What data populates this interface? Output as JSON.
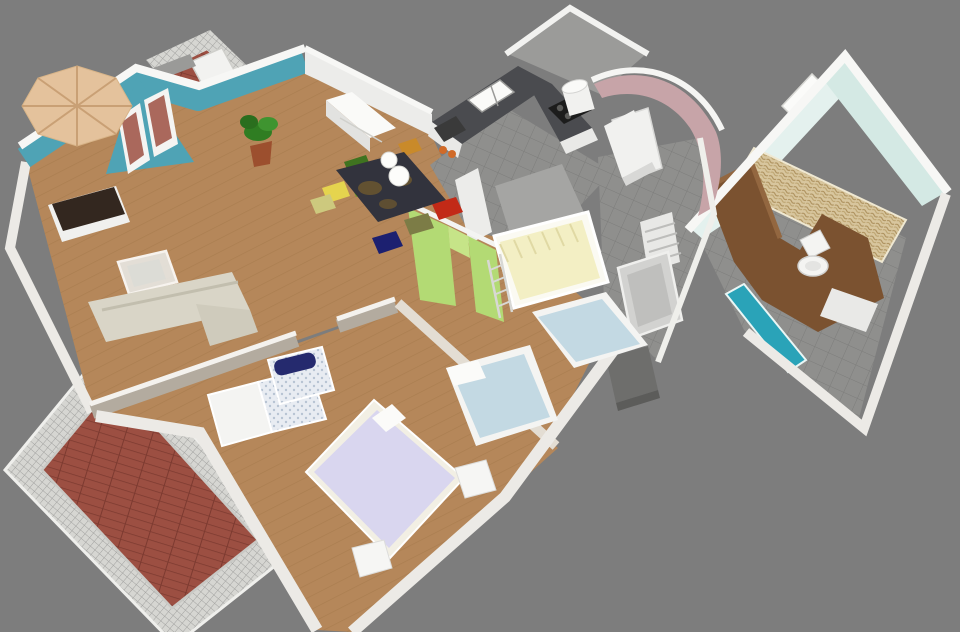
{
  "meta": {
    "width": 960,
    "height": 632,
    "description": "3D isometric cutaway rendering of a furnished apartment floor plan viewed from above on a plain gray background"
  },
  "palette": {
    "background": "#7d7d7d",
    "wall_white": "#ececea",
    "wall_cap": "#f7f7f5",
    "wall_outer": "#eceae6",
    "wall_greige": "#b3ab9f",
    "teal_wall": "#4fa3b5",
    "teal_door": "#2aa3b8",
    "aqua_wall_light": "#e4f1ee",
    "aqua_wall_dark": "#d4e9e4",
    "green_wall": "#b3da74",
    "green_wall_light": "#c6e488",
    "pink_wall": "#c7a4a8",
    "wood_floor": "#b5875a",
    "tile_gray": "#8f8f8d",
    "brick": "#9c4f42",
    "railing": "#d6d6d2",
    "sofa_beige": "#d9d5c7",
    "coffee_table_glass": "#e8e8e4",
    "table_dark": "#32333d",
    "sideboard_brown": "#33271f",
    "chair_green": "#3f7320",
    "chair_lime": "#76a02c",
    "chair_yellow": "#e5d44e",
    "chair_khaki": "#cdc97e",
    "chair_red": "#c22a17",
    "chair_olive": "#7c7c46",
    "chair_navy": "#1c2070",
    "chair_amber": "#c98a2a",
    "bed_lavender": "#d9d6ef",
    "bed_blue": "#c3d9e3",
    "bed_yellow": "#f3efc4",
    "counter_dark": "#4a4b4f",
    "cooktop_black": "#1c1c1c",
    "umbrella": "#e4c29c",
    "umbrella_fold": "#c9a075",
    "plant_green": "#2f7d22",
    "pot_terracotta": "#9c4f2e",
    "wicker": "#d8c69e",
    "wood_partition": "#7b5230",
    "navy_cushion": "#252a6e",
    "gray_armchair": "#6e6e6c",
    "appliance_white": "#f1f1ef",
    "gray_wall": "#9b9b99",
    "kids_back_wall": "#a5a5a3",
    "tub_gray": "#d2d2d0",
    "wardrobe_dots": "#e8ecf2"
  },
  "scene": {
    "type": "3d-floorplan-render",
    "background_color": "#7d7d7d",
    "outdoor": {
      "patio_umbrella": {
        "shape": "octagonal canopy",
        "color_key": "umbrella"
      },
      "upper_balcony": {
        "floor": "brick",
        "items": [
          "mesh-railing",
          "white-lounger"
        ]
      },
      "side_balcony": {
        "floor": "brick",
        "items": [
          "mesh-railing"
        ]
      },
      "terrace": {
        "floor": "brick",
        "items": [
          "mesh-railing-surround"
        ]
      }
    },
    "rooms": [
      {
        "id": "living-room",
        "floor": "wood",
        "accent_wall": "teal gable with two windows",
        "furniture": [
          "dark-sideboard",
          "l-shaped-beige-sofa",
          "glass-coffee-table",
          "potted-plant",
          "white-sideboard"
        ]
      },
      {
        "id": "dining-area",
        "floor": "wood",
        "furniture": [
          "dark-dining-table-with-gold-pattern",
          "two-white-pendant-globes",
          "high-chair"
        ],
        "chair_colors": [
          "chair_green",
          "chair_lime",
          "chair_yellow",
          "chair_khaki",
          "chair_red",
          "chair_olive",
          "chair_navy",
          "chair_amber"
        ]
      },
      {
        "id": "kitchen",
        "floor": "gray-tile",
        "furniture": [
          "white-cabinets",
          "dark-countertop",
          "double-sink",
          "black-cooktop",
          "water-heater-cylinder",
          "coffee-machine",
          "tall-white-cabinet"
        ]
      },
      {
        "id": "entry-hall",
        "floor": "gray-tile",
        "accent_wall": "curved pink wall",
        "furniture": [
          "tall-white-shelf"
        ]
      },
      {
        "id": "kids-bedroom",
        "floor": "wood",
        "accent_wall": "green wall with doorway",
        "furniture": [
          "yellow-loft-bed",
          "ladder",
          "blue-single-bed-right",
          "blue-single-bed-left"
        ]
      },
      {
        "id": "master-bedroom",
        "floor": "wood",
        "walls": "greige",
        "furniture": [
          "lavender-double-bed",
          "nightstand-right",
          "nightstand-foot",
          "white-wardrobe",
          "dotted-dresser",
          "navy-bolster"
        ]
      },
      {
        "id": "small-bathroom",
        "floor": "gray-tile",
        "furniture": [
          "bathtub",
          "towel-radiator",
          "gray-armchair"
        ]
      },
      {
        "id": "bathroom",
        "floor": "gray-tile",
        "walls": "aqua",
        "furniture": [
          "toilet",
          "wood-partition",
          "wicker-storage-wall",
          "teal-door",
          "shower-mat",
          "window"
        ]
      }
    ]
  }
}
